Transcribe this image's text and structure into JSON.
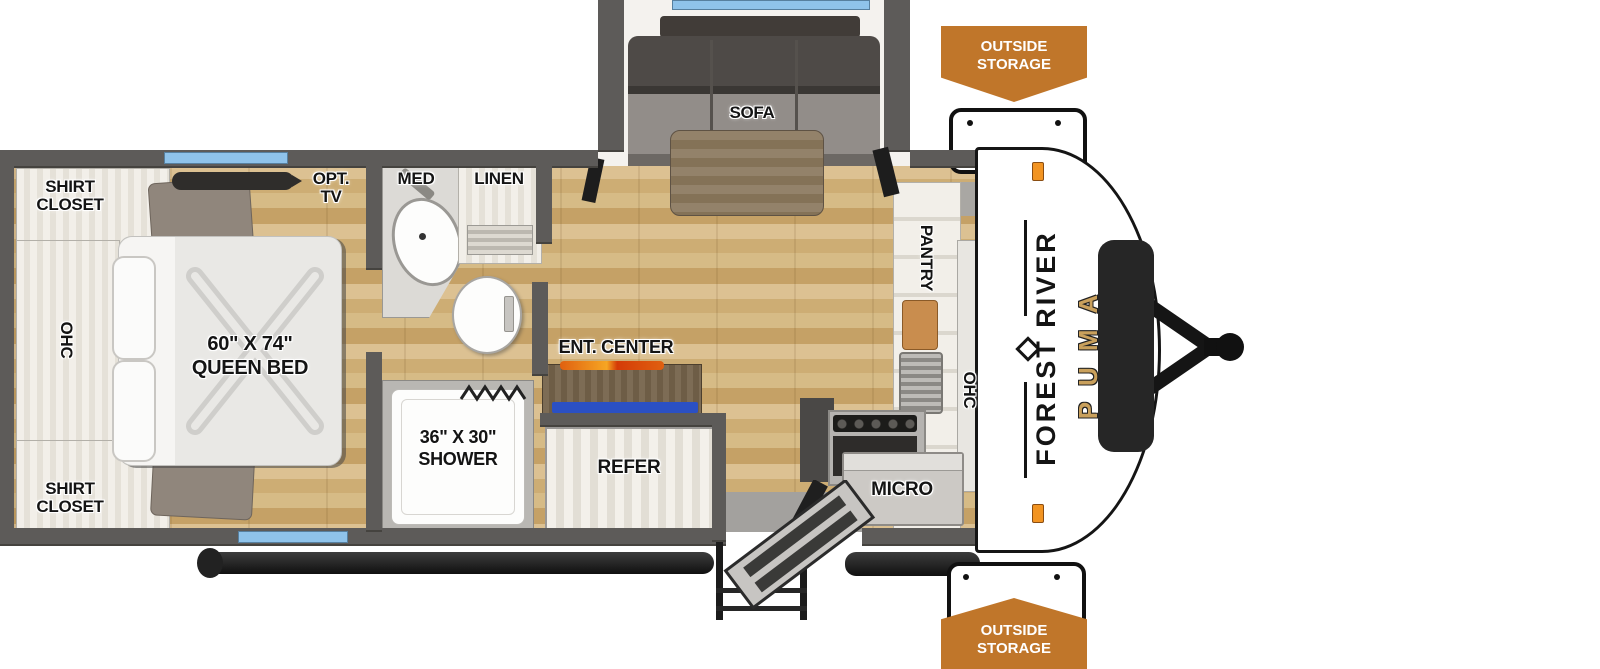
{
  "floorplan": {
    "bedroom": {
      "shirt_closet": "SHIRT CLOSET",
      "ohc": "OHC",
      "opt_tv": "OPT. TV",
      "bed_size": "60\" X 74\"",
      "bed_type": "QUEEN BED"
    },
    "bathroom": {
      "med": "MED",
      "linen": "LINEN",
      "shower_size": "36\" X 30\"",
      "shower": "SHOWER"
    },
    "living": {
      "sofa": "SOFA",
      "ent_center": "ENT. CENTER",
      "refer": "REFER"
    },
    "kitchen": {
      "pantry": "PANTRY",
      "ohc": "OHC",
      "micro": "MICRO"
    },
    "exterior": {
      "outside_storage": "OUTSIDE STORAGE",
      "brand": "FOREST RIVER",
      "model": "PUMA"
    },
    "colors": {
      "badge_orange": "#C0762A",
      "window_blue": "#8FC3EA",
      "wall_gray": "#5D5B59",
      "flame_orange": "#E8641B",
      "media_blue": "#2B50C4",
      "puma_gold": "#C9A05C",
      "floor_wood": "#CDAD74"
    }
  }
}
